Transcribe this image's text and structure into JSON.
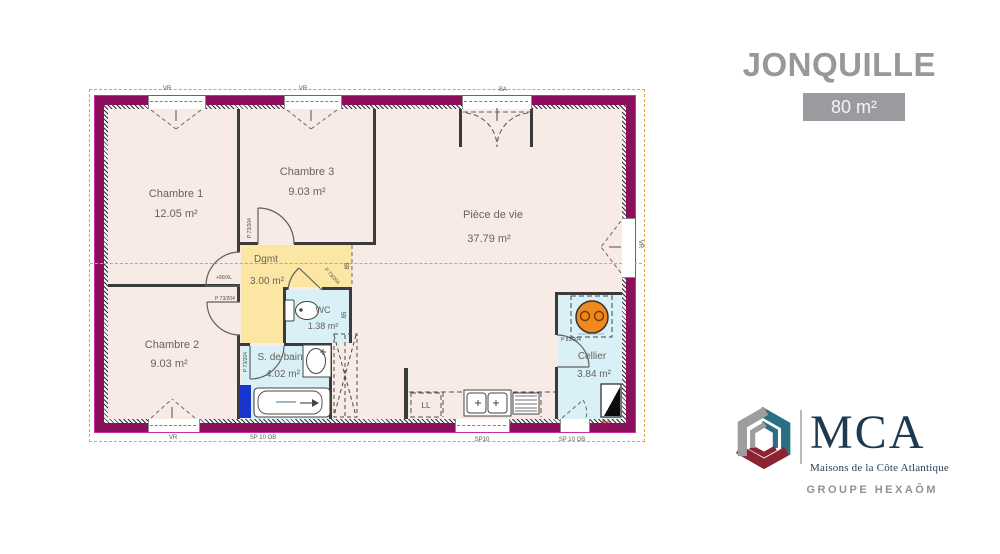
{
  "header": {
    "title": "JONQUILLE",
    "area_badge": "80 m²"
  },
  "rooms": [
    {
      "name": "Chambre 1",
      "area": "12.05 m²"
    },
    {
      "name": "Chambre 3",
      "area": "9.03 m²"
    },
    {
      "name": "Pièce de vie",
      "area": "37.79 m²"
    },
    {
      "name": "Dgmt",
      "area": "3.00 m²"
    },
    {
      "name": "WC",
      "area": "1.38 m²"
    },
    {
      "name": "S. de bain",
      "area": "4.02 m²"
    },
    {
      "name": "Chambre 2",
      "area": "9.03 m²"
    },
    {
      "name": "Cellier",
      "area": "3.84 m²"
    }
  ],
  "annotations": {
    "door_ref": "P 73/204",
    "cellier_door_ref": "P 83/204",
    "threshold_ref": "+90/XL",
    "passage_width": "85",
    "washer": "LL",
    "shutter": "VR",
    "bay": "BA",
    "sill_small": "SP10",
    "sill": "SP 10 OB"
  },
  "logo": {
    "acronym": "MCA",
    "name": "Maisons de la Côte Atlantique",
    "group": "GROUPE HEXAÔM"
  },
  "colors": {
    "wall": "#8c0f5e",
    "wall_outline": "#c5309c",
    "floor": "#f8eae4",
    "corridor": "#fbe7a3",
    "wet_room": "#d8f0f6",
    "roof_dash": "#e2a33e",
    "water_heater": "#f0891d",
    "door_panel_blue": "#1836cf",
    "title_gray": "#97989a",
    "logo_navy": "#1c3a52",
    "logo_teal": "#2a6f82",
    "logo_red": "#8c2333",
    "logo_gray": "#9d9da0"
  }
}
